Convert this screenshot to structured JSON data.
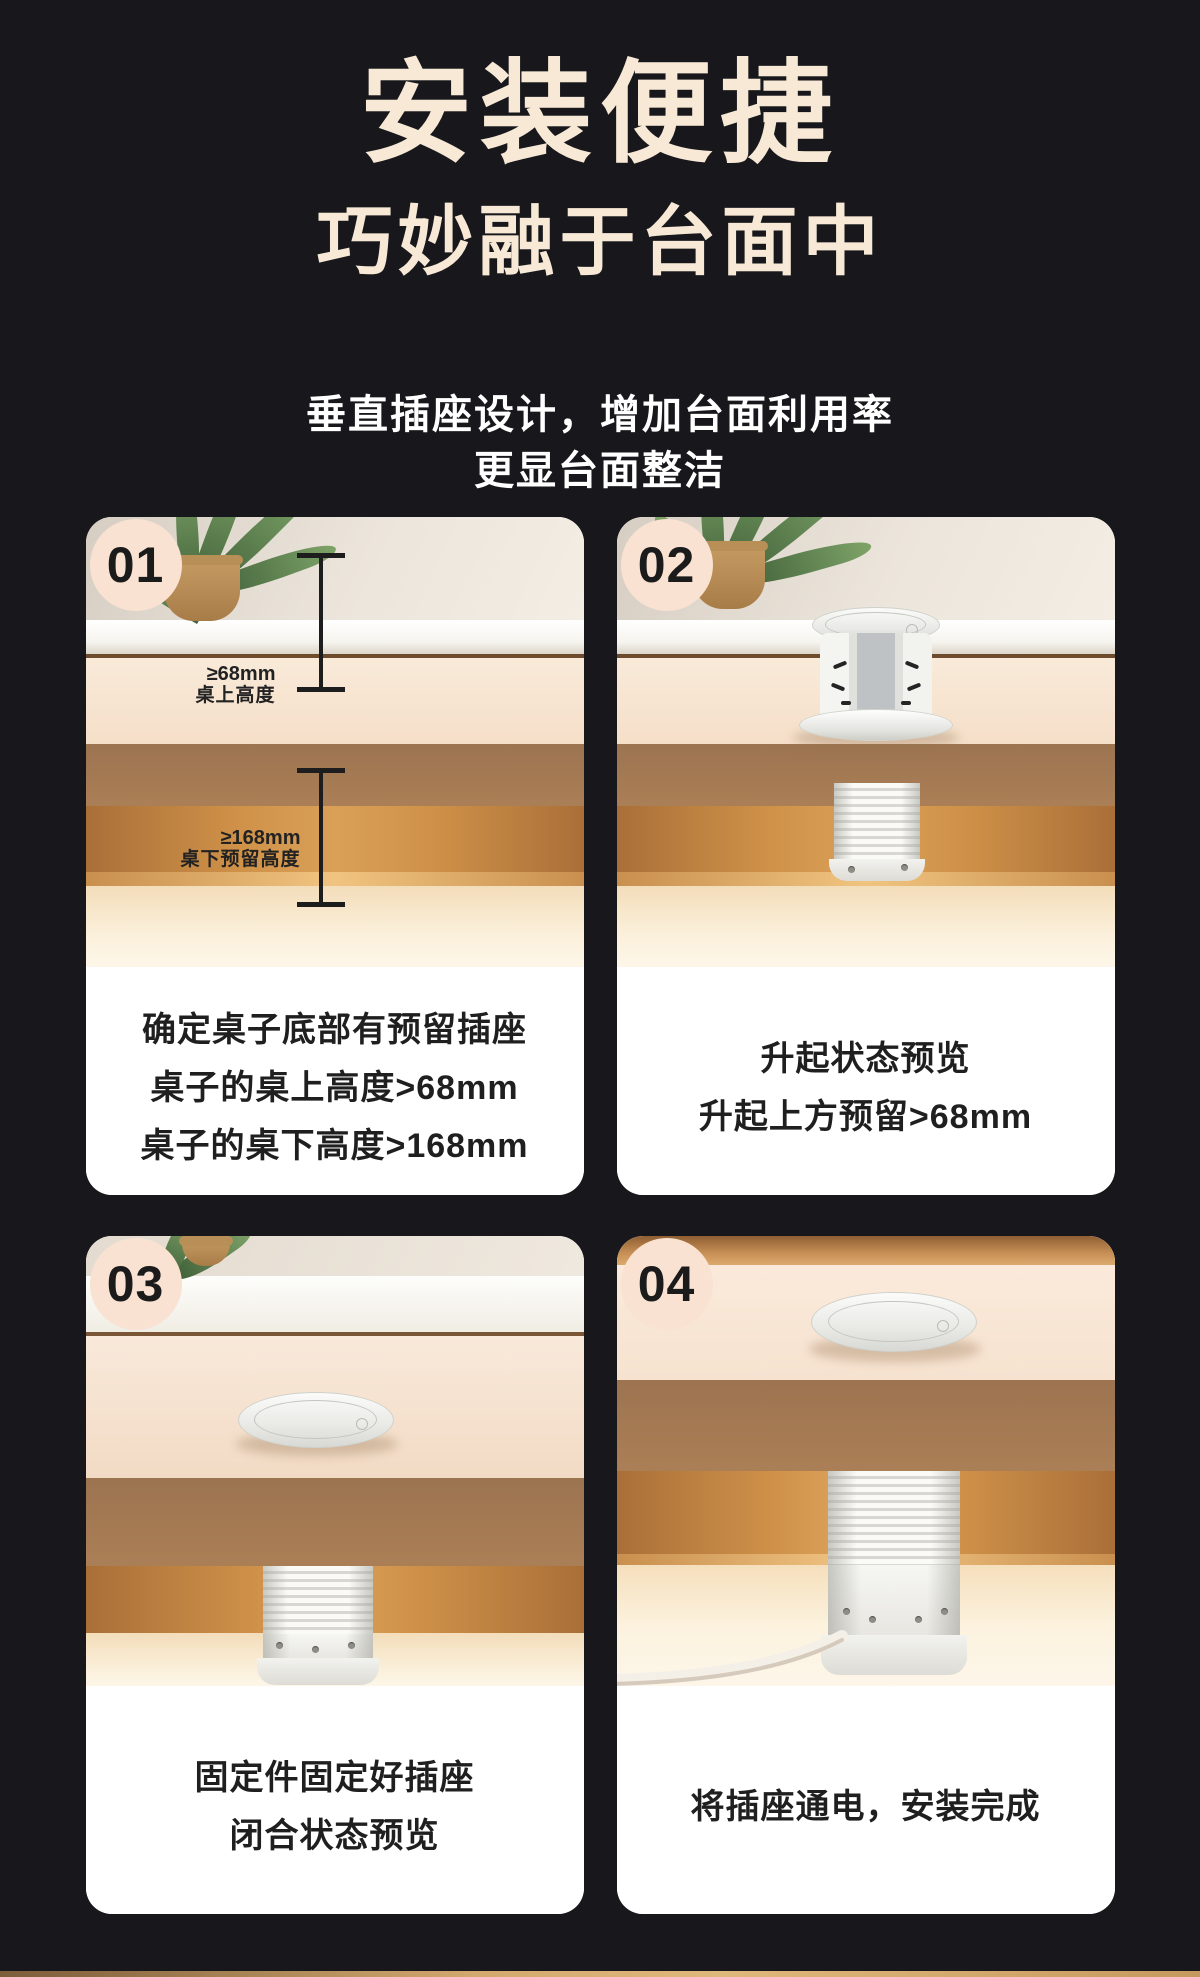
{
  "header": {
    "title": "安装便捷",
    "subtitle": "巧妙融于台面中",
    "desc1": "垂直插座设计，增加台面利用率",
    "desc2": "更显台面整洁"
  },
  "colors": {
    "background": "#17171c",
    "title_cream": "#f7e9d6",
    "badge_cream": "#f9e2d1",
    "description_text": "#ffffff",
    "caption_text": "#1f1f1f",
    "caption_bg": "#ffffff",
    "bottom_strip": "#d3a96e"
  },
  "cards": [
    {
      "number": "01",
      "caption_lines": [
        "确定桌子底部有预留插座",
        "桌子的桌上高度>68mm",
        "桌子的桌下高度>168mm"
      ],
      "annotations": [
        {
          "value": "≥68mm",
          "label": "桌上高度"
        },
        {
          "value": "≥168mm",
          "label": "桌下预留高度"
        }
      ]
    },
    {
      "number": "02",
      "caption_lines": [
        "升起状态预览",
        "升起上方预留>68mm"
      ]
    },
    {
      "number": "03",
      "caption_lines": [
        "固定件固定好插座",
        "闭合状态预览"
      ]
    },
    {
      "number": "04",
      "caption_lines": [
        "将插座通电，安装完成"
      ]
    }
  ]
}
